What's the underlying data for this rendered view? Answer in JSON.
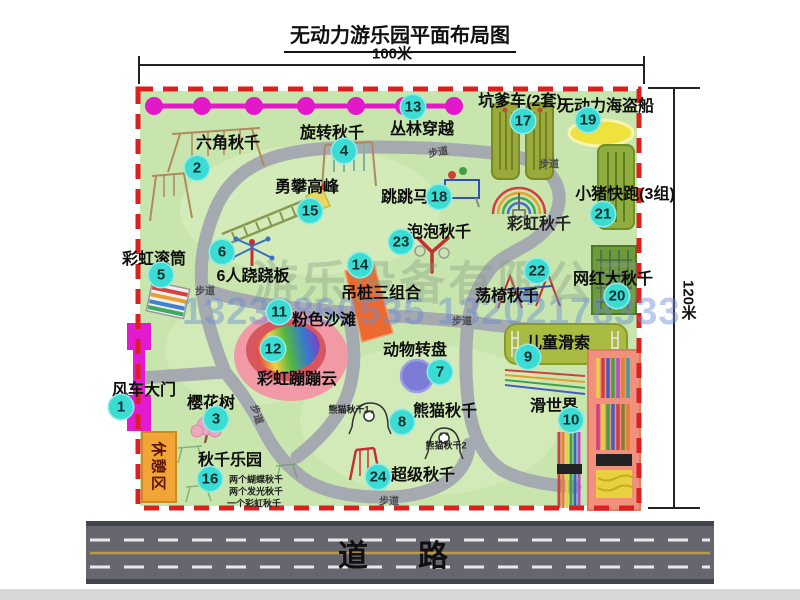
{
  "title": "无动力游乐园平面布局图",
  "dimensions": {
    "width_label": "100米",
    "height_label": "120米"
  },
  "road": {
    "label": "道　路"
  },
  "watermark": {
    "company": "游乐设备有限公司",
    "phones": "13233860535 13202178333"
  },
  "rest_area_label": "休憩区",
  "walkway_label": "步道",
  "colors": {
    "park_green": "#c8e5ad",
    "border_red": "#dc1f1f",
    "path_gray": "#a5aab0",
    "badge_cyan": "#3bdcd4",
    "gate_magenta": "#e21ad0",
    "jungle_magenta": "#e318c8",
    "road_gray": "#66666e",
    "rest_orange": "#f2a435"
  },
  "attractions": [
    {
      "num": "1",
      "label": "风车大门",
      "badge": [
        121,
        407
      ],
      "label_pos": [
        144,
        388
      ]
    },
    {
      "num": "2",
      "label": "六角秋千",
      "badge": [
        197,
        168
      ],
      "label_pos": [
        228,
        141
      ]
    },
    {
      "num": "3",
      "label": "樱花树",
      "badge": [
        216,
        419
      ],
      "label_pos": [
        211,
        401
      ]
    },
    {
      "num": "4",
      "label": "旋转秋千",
      "badge": [
        344,
        151
      ],
      "label_pos": [
        332,
        131
      ]
    },
    {
      "num": "5",
      "label": "彩虹滚筒",
      "badge": [
        161,
        275
      ],
      "label_pos": [
        154,
        257
      ]
    },
    {
      "num": "6",
      "label": "6人跷跷板",
      "badge": [
        222,
        252
      ],
      "label_pos": [
        253,
        274
      ]
    },
    {
      "num": "7",
      "label": "动物转盘",
      "badge": [
        440,
        372
      ],
      "label_pos": [
        415,
        348
      ]
    },
    {
      "num": "8",
      "label": "熊猫秋千",
      "badge": [
        402,
        422
      ],
      "label_pos": [
        445,
        409
      ]
    },
    {
      "num": "9",
      "label": "儿童滑索",
      "badge": [
        528,
        357
      ],
      "label_pos": [
        558,
        341
      ]
    },
    {
      "num": "10",
      "label": "滑世界",
      "badge": [
        571,
        420
      ],
      "label_pos": [
        554,
        404
      ]
    },
    {
      "num": "11",
      "label": "粉色沙滩",
      "badge": [
        279,
        312
      ],
      "label_pos": [
        324,
        318
      ]
    },
    {
      "num": "12",
      "label": "彩虹蹦蹦云",
      "badge": [
        273,
        349
      ],
      "label_pos": [
        297,
        377
      ]
    },
    {
      "num": "13",
      "label": "丛林穿越",
      "badge": [
        413,
        107
      ],
      "label_pos": [
        422,
        127
      ]
    },
    {
      "num": "14",
      "label": "吊桩三组合",
      "badge": [
        360,
        265
      ],
      "label_pos": [
        381,
        291
      ]
    },
    {
      "num": "15",
      "label": "勇攀高峰",
      "badge": [
        310,
        211
      ],
      "label_pos": [
        307,
        185
      ]
    },
    {
      "num": "16",
      "label": "秋千乐园",
      "badge": [
        210,
        479
      ],
      "label_pos": [
        230,
        458
      ]
    },
    {
      "num": "17",
      "label": "坑爹车(2套)",
      "badge": [
        523,
        121
      ],
      "label_pos": [
        520,
        99
      ]
    },
    {
      "num": "18",
      "label": "跳跳马",
      "badge": [
        439,
        197
      ],
      "label_pos": [
        405,
        195
      ]
    },
    {
      "num": "19",
      "label": "无动力海盗船",
      "badge": [
        588,
        120
      ],
      "label_pos": [
        606,
        104
      ]
    },
    {
      "num": "20",
      "label": "网红大秋千",
      "badge": [
        617,
        296
      ],
      "label_pos": [
        613,
        277
      ]
    },
    {
      "num": "21",
      "label": "小猪快跑(3组)",
      "badge": [
        603,
        214
      ],
      "label_pos": [
        625,
        192
      ]
    },
    {
      "num": "22",
      "label": "荡椅秋千",
      "badge": [
        537,
        271
      ],
      "label_pos": [
        507,
        294
      ]
    },
    {
      "num": "23",
      "label": "泡泡秋千",
      "badge": [
        401,
        242
      ],
      "label_pos": [
        439,
        230
      ]
    },
    {
      "num": "24",
      "label": "超级秋千",
      "badge": [
        378,
        477
      ],
      "label_pos": [
        423,
        473
      ]
    }
  ],
  "extra_labels": [
    {
      "text": "彩虹秋千",
      "pos": [
        539,
        222
      ],
      "size": 16
    },
    {
      "text": "熊猫秋千1",
      "pos": [
        349,
        409
      ],
      "size": 9
    },
    {
      "text": "熊猫秋千2",
      "pos": [
        446,
        445
      ],
      "size": 9
    },
    {
      "text": "两个蝴蝶秋千",
      "pos": [
        256,
        479
      ],
      "size": 9
    },
    {
      "text": "两个发光秋千",
      "pos": [
        256,
        491
      ],
      "size": 9
    },
    {
      "text": "一个彩虹秋千",
      "pos": [
        254,
        503
      ],
      "size": 9
    }
  ],
  "walkway_label_positions": [
    {
      "pos": [
        438,
        151
      ],
      "rot": -10
    },
    {
      "pos": [
        549,
        163
      ],
      "rot": 0
    },
    {
      "pos": [
        205,
        290
      ],
      "rot": 0
    },
    {
      "pos": [
        258,
        414
      ],
      "rot": 72
    },
    {
      "pos": [
        462,
        320
      ],
      "rot": 0
    },
    {
      "pos": [
        389,
        500
      ],
      "rot": 0
    }
  ]
}
